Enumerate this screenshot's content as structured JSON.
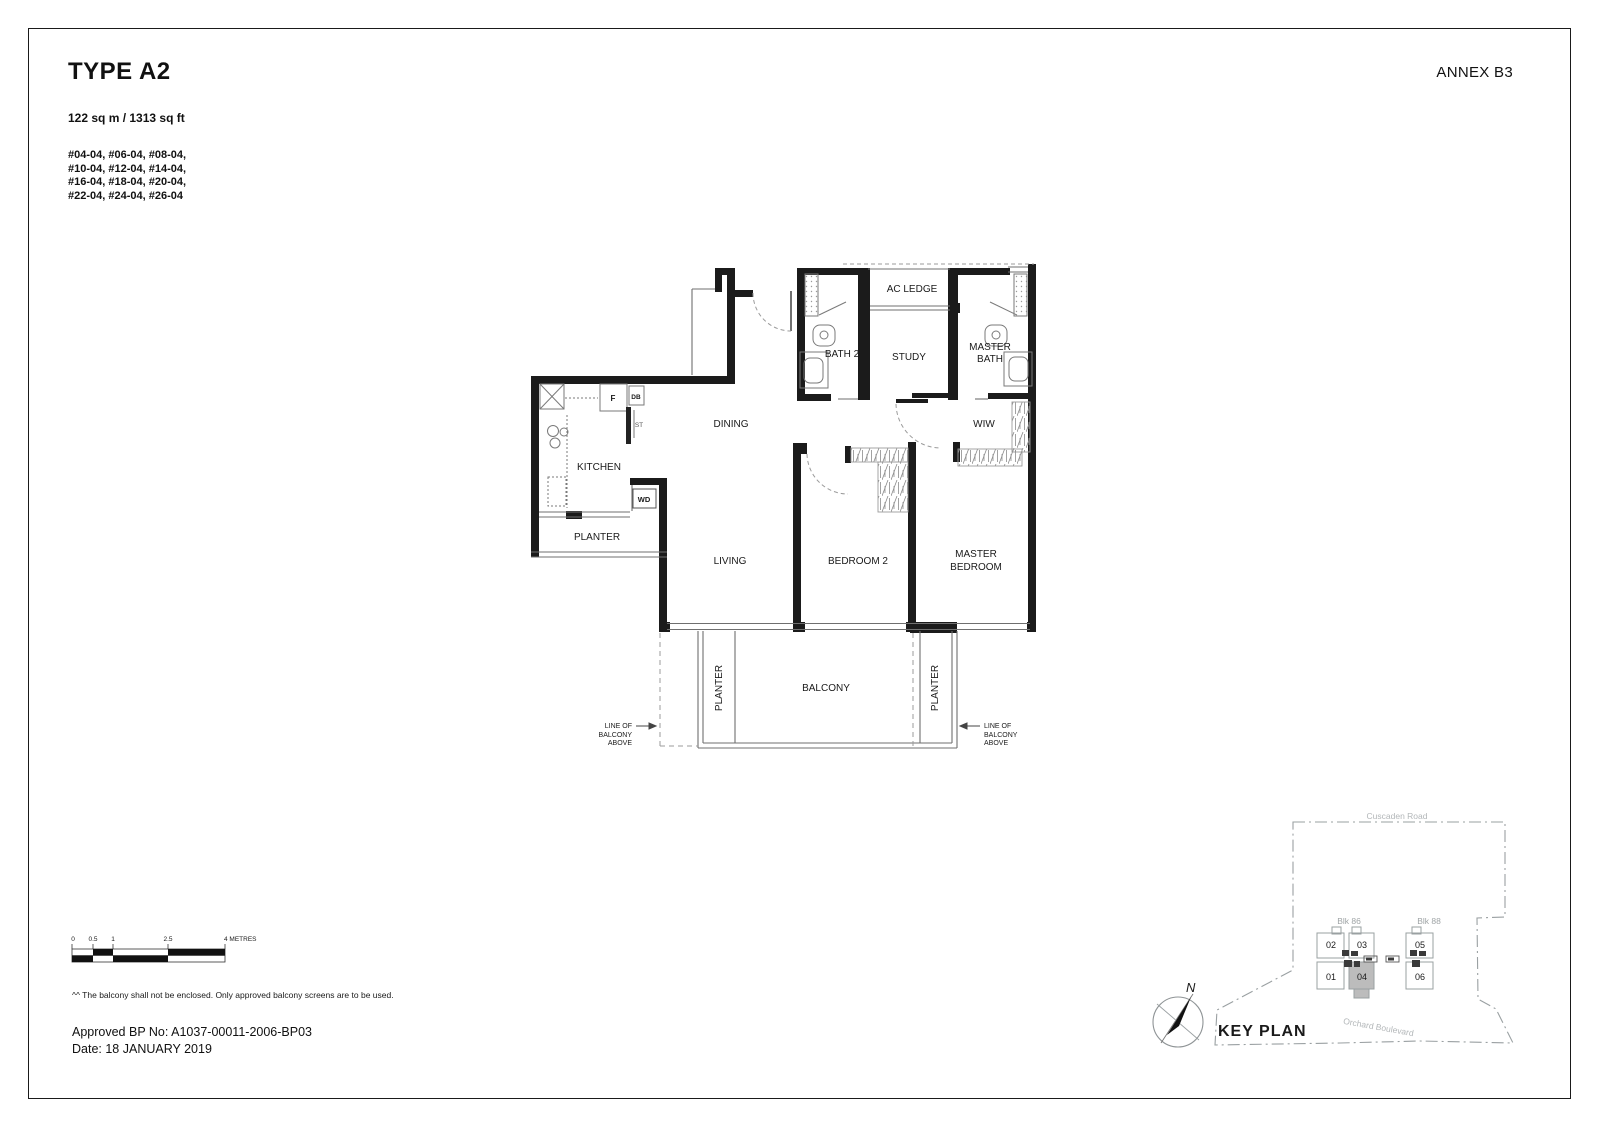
{
  "header": {
    "title": "TYPE A2",
    "annex": "ANNEX B3",
    "area": "122 sq m / 1313 sq ft",
    "units": [
      "#04-04, #06-04, #08-04,",
      "#10-04, #12-04, #14-04,",
      "#16-04, #18-04, #20-04,",
      "#22-04, #24-04, #26-04"
    ]
  },
  "floorplan": {
    "labels": {
      "ac_ledge": "AC LEDGE",
      "bath2": "BATH 2",
      "study": "STUDY",
      "master_bath": [
        "MASTER",
        "BATH"
      ],
      "dining": "DINING",
      "wiw": "WIW",
      "kitchen": "KITCHEN",
      "living": "LIVING",
      "bedroom2": "BEDROOM 2",
      "master_bedroom": [
        "MASTER",
        "BEDROOM"
      ],
      "balcony": "BALCONY",
      "planter": "PLANTER",
      "fridge": "F",
      "db": "DB",
      "st": "ST",
      "wd": "WD",
      "line_of_balcony": [
        "LINE OF",
        "BALCONY",
        "ABOVE"
      ]
    }
  },
  "scalebar": {
    "ticks": [
      "0",
      "0.5",
      "1",
      "2.5"
    ],
    "end_label": "4 METRES"
  },
  "keyplan": {
    "title": "KEY PLAN",
    "north_label": "N",
    "road_top": "Cuscaden Road",
    "road_bottom": "Orchard Boulevard",
    "blk_left": "Blk 86",
    "blk_right": "Blk 88",
    "units_left": [
      "02",
      "03",
      "01",
      "04"
    ],
    "units_right": [
      "05",
      "06"
    ],
    "highlighted_unit": "04"
  },
  "footer": {
    "note": "^^ The balcony shall not be enclosed. Only approved balcony screens are to be used.",
    "bp": "Approved BP No: A1037-00011-2006-BP03",
    "date": "Date: 18 JANUARY 2019"
  },
  "colors": {
    "wall": "#1b1b1b",
    "thin_line": "#6f6f6f",
    "dash_line": "#9b9b9b",
    "keyplan_line": "#9aa0a2",
    "keyplan_text": "#aeb2b4",
    "highlight_unit_fill": "#bcbcbc"
  }
}
